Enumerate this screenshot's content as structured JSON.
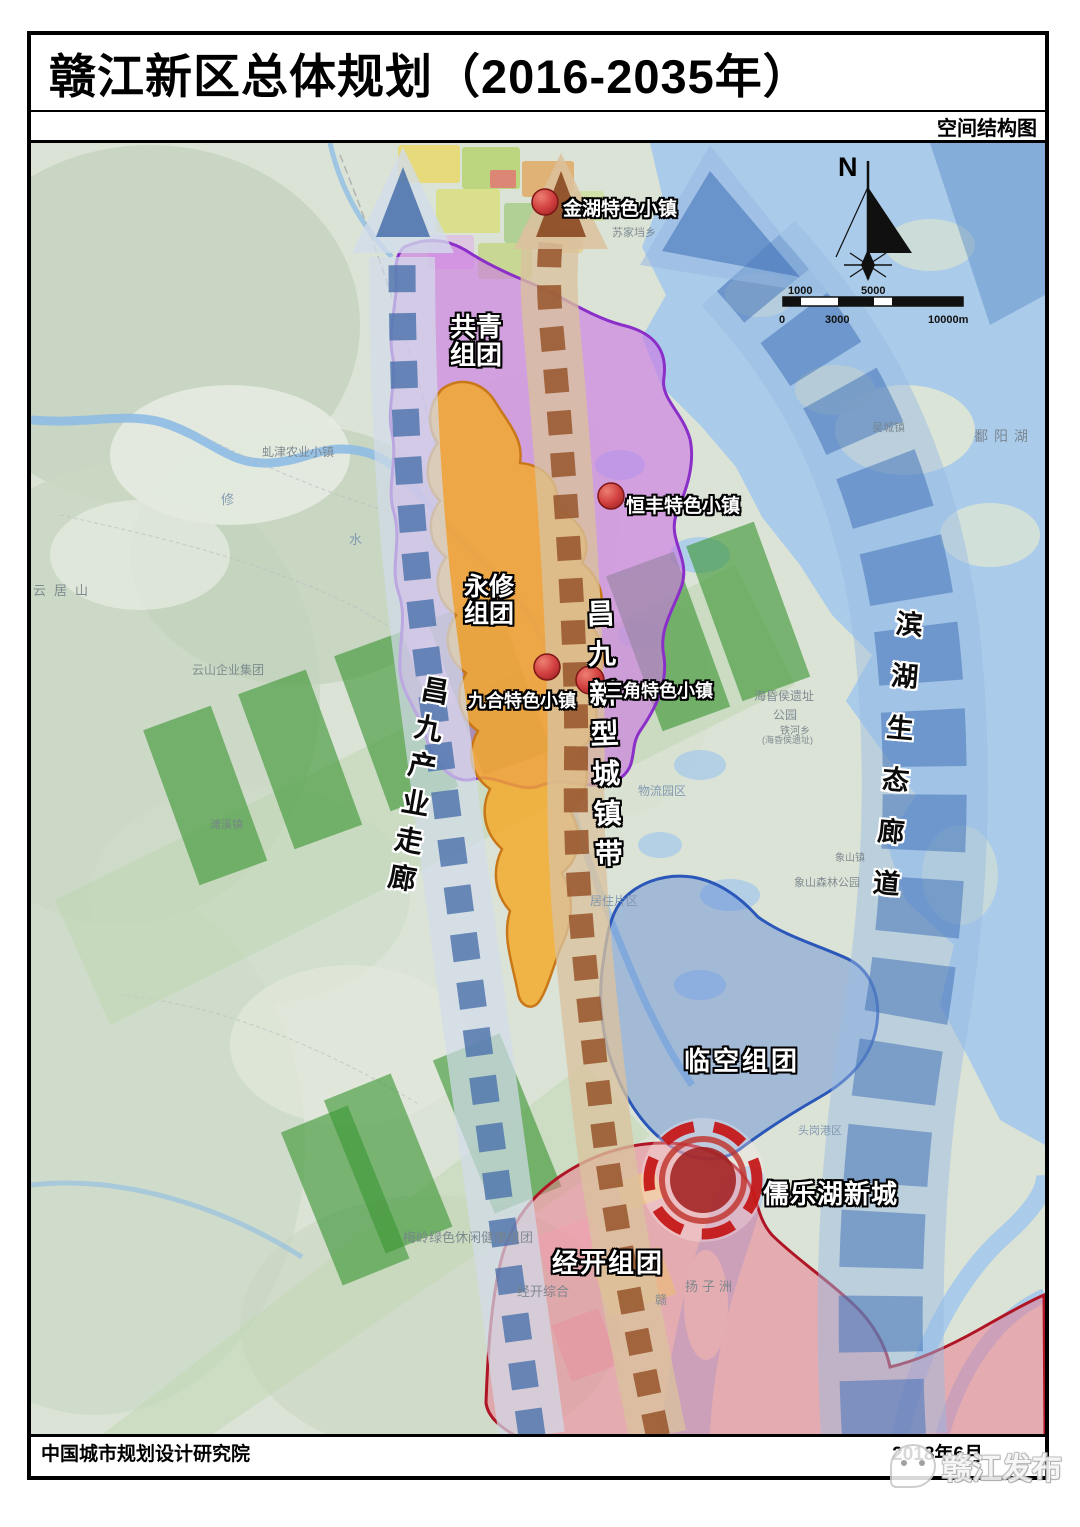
{
  "header": {
    "title": "赣江新区总体规划（2016-2035年）",
    "subtitle": "空间结构图"
  },
  "map": {
    "compass_label": "N",
    "scalebar": {
      "top": [
        "1000",
        "5000"
      ],
      "bottom": [
        "0",
        "3000",
        "10000m"
      ]
    },
    "corridors": [
      {
        "label": "昌九产业走廊",
        "color": "#4a72a8"
      },
      {
        "label": "昌九新型城镇带",
        "color": "#94542a"
      },
      {
        "label": "滨湖生态廊道",
        "color": "#3c6eb2"
      }
    ],
    "clusters": [
      {
        "lines": [
          "共青",
          "组团"
        ],
        "color": "#c878dc"
      },
      {
        "lines": [
          "永修",
          "组团"
        ],
        "color": "#f2a738"
      },
      {
        "lines": [
          "临空组团"
        ],
        "color": "#5a82d7"
      },
      {
        "lines": [
          "经开组团"
        ],
        "color": "#e87090"
      }
    ],
    "towns": [
      {
        "label": "金湖特色小镇"
      },
      {
        "label": "恒丰特色小镇"
      },
      {
        "label": "九合特色小镇"
      },
      {
        "label": "三角特色小镇"
      }
    ],
    "new_city": {
      "label": "儒乐湖新城"
    },
    "marker_color": "#cf3a3a",
    "eco_green": "#3f9f3c",
    "water_color": "#aacbe9",
    "basemap_labels": [
      {
        "text": "虬津农业小镇"
      },
      {
        "text": "修"
      },
      {
        "text": "水"
      },
      {
        "text": "云居山"
      },
      {
        "text": "云山企业集团"
      },
      {
        "text": "滩溪镇"
      },
      {
        "text": "苏家垱乡"
      },
      {
        "text": "吴城镇"
      },
      {
        "text": "鄱阳湖"
      },
      {
        "text": "海昏侯遗址"
      },
      {
        "text": "公园"
      },
      {
        "text": "铁河乡"
      },
      {
        "text": "(海昏侯遗址)"
      },
      {
        "text": "物流园区"
      },
      {
        "text": "象山镇"
      },
      {
        "text": "象山森林公园"
      },
      {
        "text": "居住片区"
      },
      {
        "text": "头岗港区"
      },
      {
        "text": "梅岭绿色休闲健康组团"
      },
      {
        "text": "经开综合"
      },
      {
        "text": "扬子洲"
      },
      {
        "text": "赣"
      }
    ]
  },
  "footer": {
    "left": "中国城市规划设计研究院",
    "right": "2018年6月",
    "watermark": "赣江发布"
  }
}
